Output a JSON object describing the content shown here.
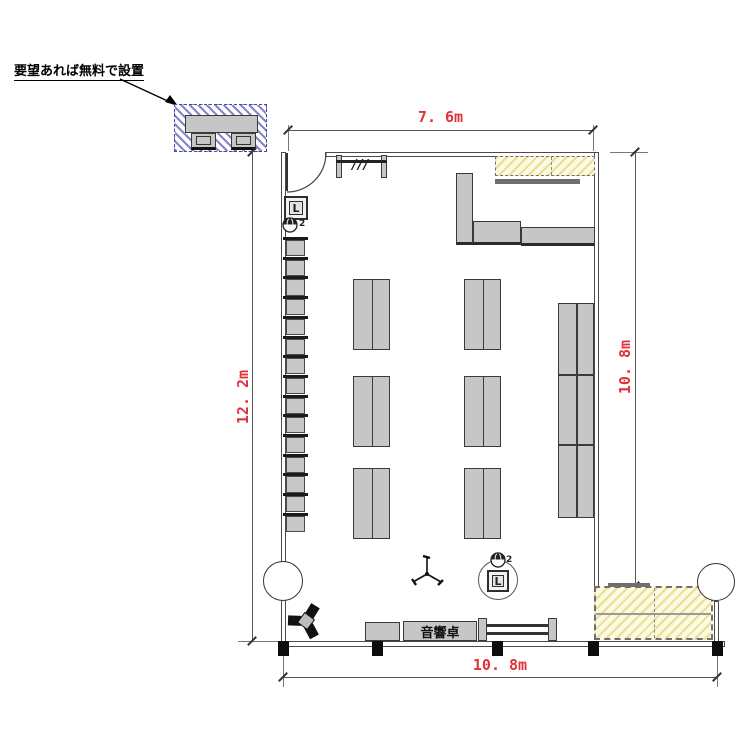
{
  "callout": {
    "text": "要望あれば無料で設置"
  },
  "dimensions": {
    "top": "7. 6m",
    "left": "12. 2m",
    "right": "10. 8m",
    "bottom": "10. 8m"
  },
  "labels": {
    "sound_desk": "音響卓",
    "speaker_box_left": "L",
    "speaker_box_bottom": "L",
    "ceiling_speaker_count_left": "2",
    "ceiling_speaker_count_bottom": "2",
    "partition_marks": "///"
  },
  "colors": {
    "dimension_red": "#e03238",
    "furniture_gray": "#c6c6c6",
    "hatch_blue": "#8585c9",
    "hatch_yellow_line": "#e9df90",
    "hatch_yellow_bg": "#fdfae3",
    "line_dark": "#333333"
  },
  "geometry": {
    "stacked_chairs": {
      "count": 15,
      "x": 283,
      "start_y": 237,
      "step": 19.7,
      "bar_w": 25,
      "body_w": 19
    },
    "center_tables": {
      "col_x": [
        353,
        464
      ],
      "row_y": [
        279,
        376,
        468
      ],
      "w": 37,
      "h": 71
    },
    "right_block": {
      "x": 558,
      "y": 303,
      "w": 36,
      "row_h": [
        72,
        70,
        73
      ]
    },
    "bottom_posts": {
      "xs": [
        278,
        372,
        492,
        588,
        712
      ],
      "y": 641,
      "w": 11,
      "h": 15
    }
  }
}
